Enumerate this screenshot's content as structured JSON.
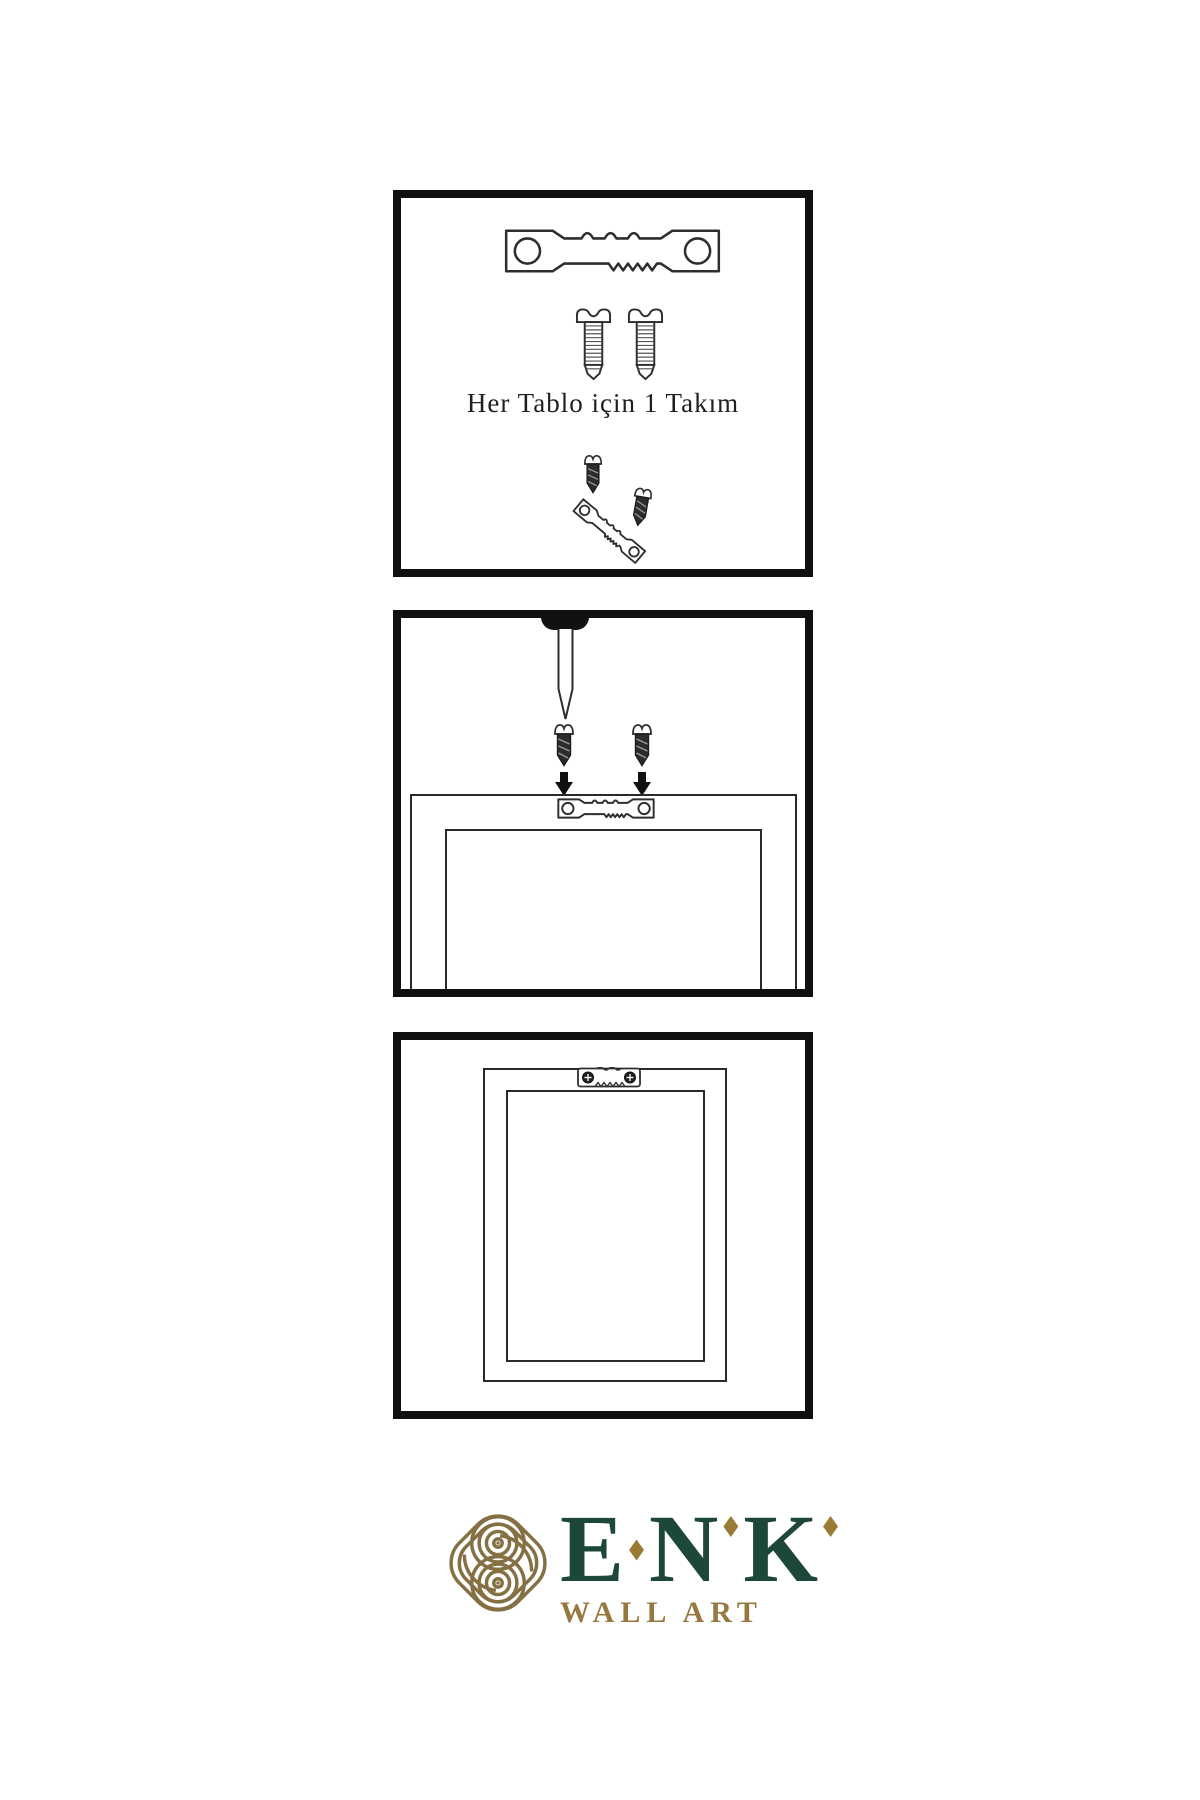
{
  "kit": {
    "caption": "Her Tablo için 1 Takım"
  },
  "brand": {
    "name": "ENK",
    "letters": [
      "E",
      "N",
      "K"
    ],
    "tagline": "WALL ART"
  },
  "colors": {
    "line_art": "#2e2e2e",
    "panel_border": "#101010",
    "brand_green": "#1d4736",
    "brand_gold": "#97793f",
    "logo_knot_gold": "#857043",
    "diamond_gold": "#9a7b35",
    "background": "#ffffff"
  }
}
